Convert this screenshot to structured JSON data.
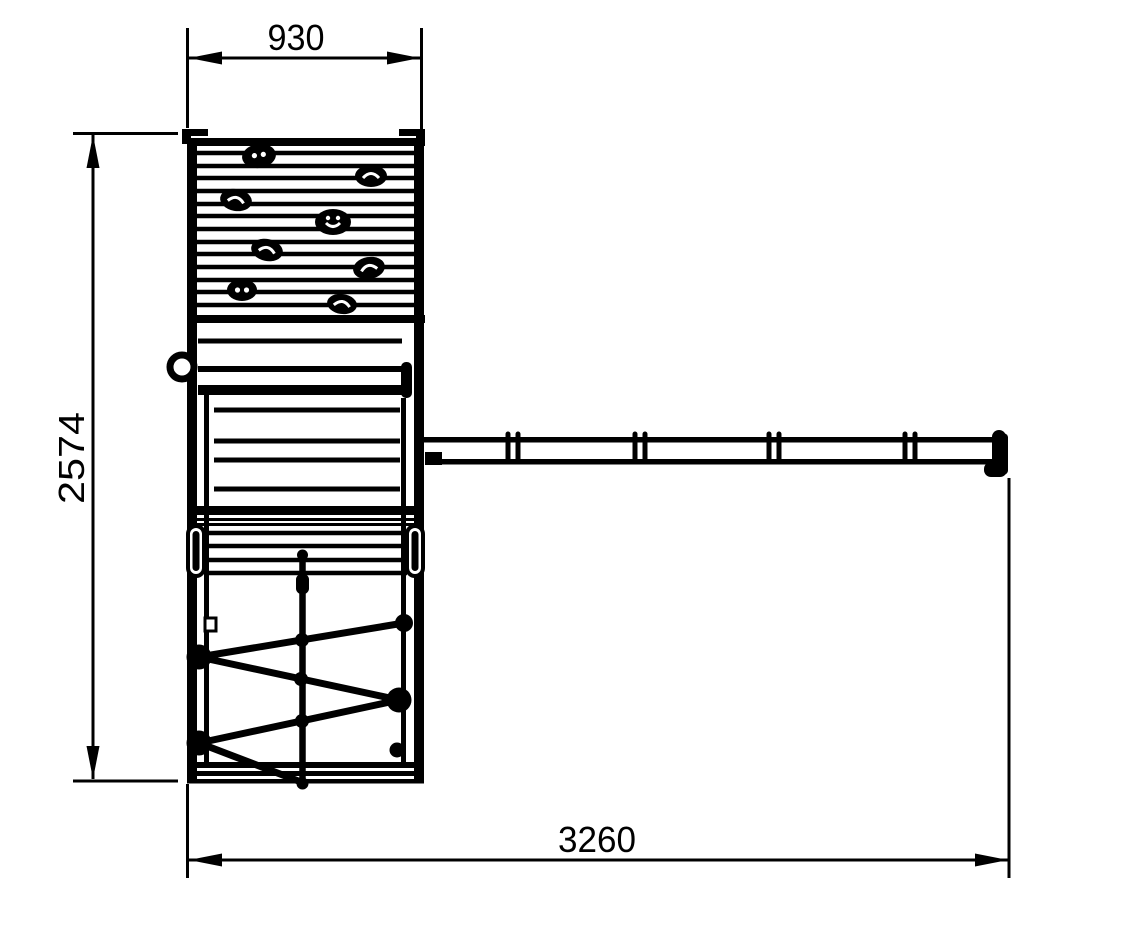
{
  "drawing": {
    "subject": "playground-tower-with-climbing-wall-net-and-swing-beam",
    "dimensions": {
      "top_width": "930",
      "left_height": "2574",
      "bottom_width": "3260"
    },
    "colors": {
      "line": "#000000",
      "background": "#ffffff"
    }
  }
}
